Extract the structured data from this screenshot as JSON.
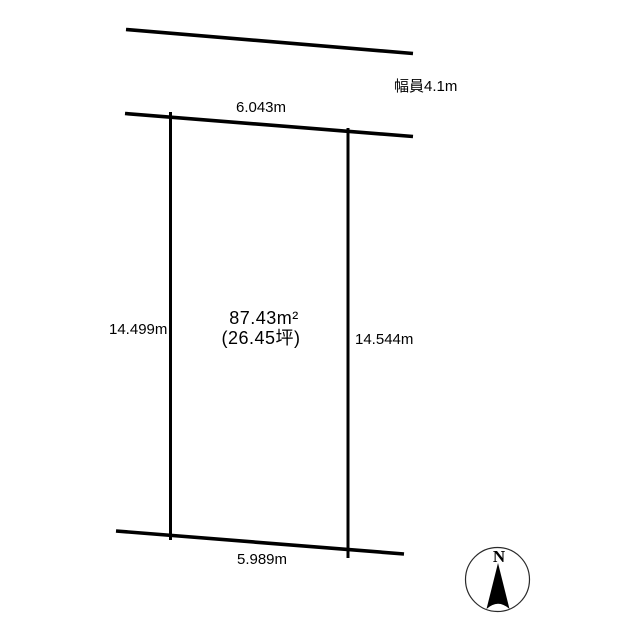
{
  "page": {
    "background_color": "#ffffff",
    "line_color": "#000000",
    "description": "land-plot-survey-diagram"
  },
  "road": {
    "width_label": "幅員4.1m"
  },
  "plot": {
    "frontage_label": "6.043m",
    "left_side_label": "14.499m",
    "right_side_label": "14.544m",
    "rear_label": "5.989m",
    "area_sqm_label": "87.43m²",
    "area_tsubo_label": "(26.45坪)"
  },
  "compass": {
    "north_label": "N"
  }
}
